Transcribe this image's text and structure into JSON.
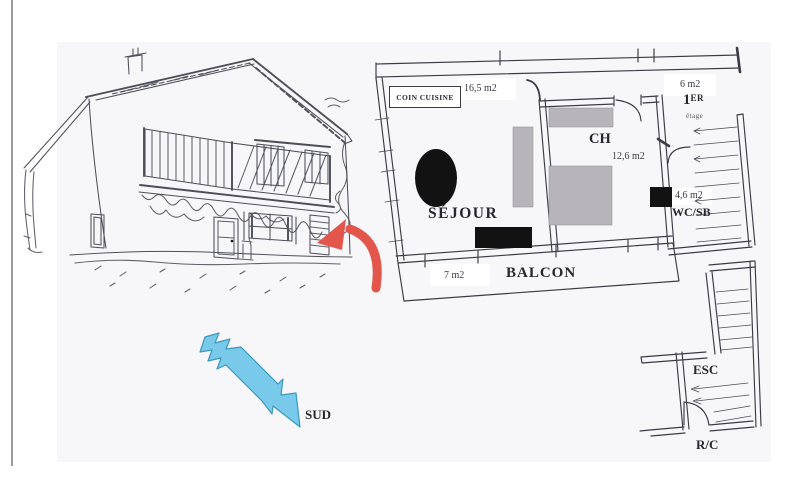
{
  "colors": {
    "page_bg": "#ffffff",
    "scan_bg": "#f7f7fa",
    "ink": "#3b3b45",
    "sketch_ink": "#4e4e58",
    "label_ink": "#26262e",
    "black_fill": "#121212",
    "furniture_gray": "#b7b5b9",
    "red_arrow": "#e2564b",
    "blue_arrow_fill": "#79c9ea",
    "blue_arrow_stroke": "#3e98c0"
  },
  "plan": {
    "kitchen_label": "COIN CUISINE",
    "living_area": "16,5 m2",
    "living_label": "SÉJOUR",
    "bedroom_label": "CH",
    "bedroom_area": "12,6 m2",
    "landing_area": "6 m2",
    "floor_label_num": "1",
    "floor_label_suffix": "ER",
    "floor_label_sub": "étage",
    "bath_area": "4,6 m2",
    "bath_label": "WC/SB",
    "balcony_area": "7 m2",
    "balcony_label": "BALCON",
    "stairs_label": "ESC",
    "ground_floor_label": "R/C"
  },
  "compass": {
    "south_label": "SUD"
  }
}
